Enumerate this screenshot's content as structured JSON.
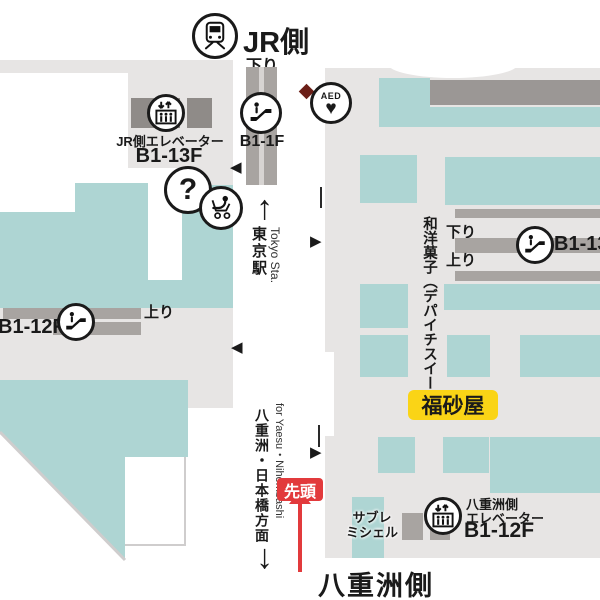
{
  "header": {
    "jr_side": "JR側"
  },
  "center": {
    "down_label": "下り",
    "b1_1f": "B1-1F",
    "tokyo_jp": "東京駅",
    "tokyo_en": "Tokyo Sta.",
    "yaesu_dir_jp": "八重洲・日本橋方面",
    "yaesu_dir_en": "for Yaesu・Nihombashi",
    "front_badge": "先頭",
    "yaesu_side_title": "八重洲側"
  },
  "left": {
    "elevator_line1": "JR側エレベーター",
    "elevator_line2": "B1-13F",
    "up_label": "上り",
    "b1_12f": "B1-12F"
  },
  "right": {
    "aed": "AED",
    "confectionery": "和洋菓子（デパイチスイーツ）",
    "down_label": "下り",
    "up_label": "上り",
    "b1_13f": "B1-13F",
    "fukusaya": "福砂屋",
    "sable_line1": "サブレ",
    "sable_line2": "ミシェル",
    "elev_line1": "八重洲側",
    "elev_line2": "エレベーター",
    "elev_line3": "B1-12F"
  },
  "icons": {
    "question": "?",
    "heart": "♥",
    "up_arrow": "↑",
    "down_arrow": "↓",
    "tri_right": "▶",
    "tri_left": "◀"
  },
  "colors": {
    "teal": "#aed5d3",
    "floor": "#e7e5e4",
    "bar_gray": "#a8a4a1",
    "bar_dark": "#9b9795",
    "elevator_block": "#8f8b88",
    "highlight_yellow": "#fad416",
    "accent_red": "#e23a3c",
    "ink": "#1a1a1a"
  }
}
